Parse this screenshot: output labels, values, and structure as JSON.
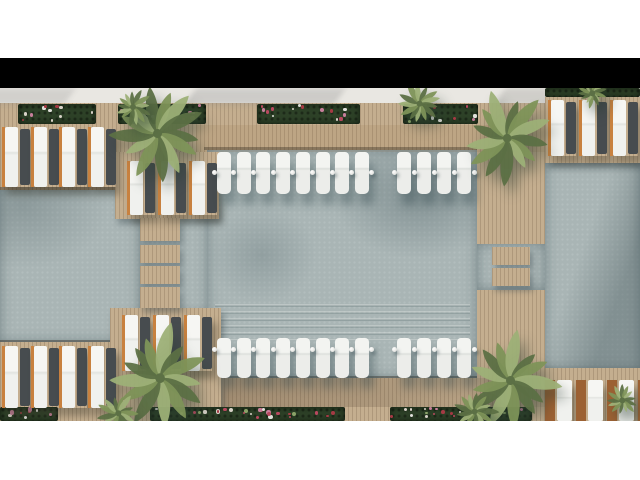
{
  "meta": {
    "scene_label": "top-down resort pool plan rendering",
    "background": "#ffffff",
    "letterbox_bar": "#000000"
  },
  "palette": {
    "sand": "#e9e7e2",
    "wood": "#c4ae8f",
    "woodDark": "#9c8468",
    "water": "#a9b5b5",
    "waterDeep": "#7e9296",
    "green": "#2d4127",
    "lwhite": "#f4f4f1",
    "ldark": "#474c4f",
    "orange": "#c8813f",
    "brown": "#9c6133",
    "palmDark": "#5c7045",
    "palmMid": "#7e9359",
    "palmLight": "#9db077",
    "dot": "#f6f6f4",
    "flowers": [
      "#b8495f",
      "#d8d2c8",
      "#c77f9b",
      "#8aa268",
      "#e0e0da",
      "#a53a44"
    ]
  },
  "frame": {
    "white_top": {
      "y": 0,
      "h": 58
    },
    "black_bar": {
      "y": 58,
      "h": 30
    },
    "white_bottom": {
      "y": 421,
      "h": 59
    }
  },
  "scene": {
    "path_strip": {
      "x": 0,
      "y": 88,
      "w": 640,
      "h": 17
    },
    "greenery_top": {
      "x": 0,
      "y": 103,
      "w": 640,
      "h": 22,
      "planters": [
        [
          18,
          96
        ],
        [
          118,
          206
        ],
        [
          257,
          360
        ],
        [
          403,
          478
        ]
      ]
    },
    "greenery_bottom": {
      "x": 0,
      "y": 407,
      "w": 545,
      "h": 14,
      "planters": [
        [
          0,
          58
        ],
        [
          150,
          345
        ],
        [
          390,
          532
        ]
      ]
    },
    "deck_base": {
      "x": 0,
      "y": 125,
      "w": 640,
      "h": 283
    },
    "pools": [
      {
        "name": "left-pool",
        "x": 0,
        "y": 190,
        "w": 140,
        "h": 152
      },
      {
        "name": "left-channel",
        "x": 140,
        "y": 200,
        "w": 68,
        "h": 115
      },
      {
        "name": "central-pool",
        "x": 207,
        "y": 150,
        "w": 270,
        "h": 228
      },
      {
        "name": "right-channel",
        "x": 477,
        "y": 244,
        "w": 68,
        "h": 46
      },
      {
        "name": "right-pool",
        "x": 545,
        "y": 162,
        "w": 95,
        "h": 208
      }
    ],
    "pool_edges": [
      {
        "x": 204,
        "y": 147,
        "w": 273,
        "h": 3
      },
      {
        "x": 207,
        "y": 376,
        "w": 270,
        "h": 2
      },
      {
        "x": 0,
        "y": 187,
        "w": 140,
        "h": 3
      },
      {
        "x": 0,
        "y": 340,
        "w": 140,
        "h": 2
      },
      {
        "x": 545,
        "y": 159,
        "w": 95,
        "h": 3
      },
      {
        "x": 545,
        "y": 368,
        "w": 95,
        "h": 2
      }
    ],
    "platforms": [
      {
        "name": "deck-topleft-extension",
        "x": 115,
        "y": 152,
        "w": 104,
        "h": 67
      },
      {
        "name": "deck-bottomcenter",
        "x": 110,
        "y": 308,
        "w": 111,
        "h": 113
      },
      {
        "name": "deck-topright-corner",
        "x": 545,
        "y": 97,
        "w": 95,
        "h": 66
      },
      {
        "name": "deck-bottomright-corner",
        "x": 545,
        "y": 368,
        "w": 95,
        "h": 53
      }
    ],
    "bridges": [
      {
        "name": "bridge-left",
        "x": 140,
        "w": 40,
        "segments": [
          [
            218,
            23
          ],
          [
            245,
            18
          ],
          [
            266,
            18
          ],
          [
            287,
            21
          ]
        ]
      },
      {
        "name": "bridge-right",
        "x": 492,
        "w": 38,
        "segments": [
          [
            247,
            18
          ],
          [
            268,
            18
          ]
        ]
      }
    ],
    "green_strip_topright": {
      "x": 545,
      "y": 88,
      "w": 95,
      "h": 9
    },
    "deck_shade_bottom": {
      "x": 196,
      "y": 378,
      "w": 349,
      "h": 29
    },
    "deck_tint_top": {
      "x": 196,
      "y": 125,
      "w": 349,
      "h": 27
    },
    "deck_loungers": [
      {
        "name": "top-left",
        "x": 2,
        "y": 127,
        "pairs": 4,
        "pitch": 28.6,
        "h": 60,
        "style": "owd"
      },
      {
        "name": "top-left-extension",
        "x": 127,
        "y": 161,
        "pairs": 3,
        "pitch": 31,
        "h": 54,
        "style": "owd"
      },
      {
        "name": "bottom-left",
        "x": 2,
        "y": 346,
        "pairs": 4,
        "pitch": 28.6,
        "h": 62,
        "style": "owd"
      },
      {
        "name": "bottom-center",
        "x": 122,
        "y": 315,
        "pairs": 3,
        "pitch": 31,
        "h": 56,
        "style": "owd"
      },
      {
        "name": "top-right",
        "x": 548,
        "y": 100,
        "pairs": 3,
        "pitch": 31,
        "h": 56,
        "style": "owd"
      },
      {
        "name": "bottom-right",
        "x": 545,
        "y": 380,
        "pairs": 4,
        "pitch": 31,
        "h": 41,
        "style": "ow"
      }
    ],
    "pool_lounger_rows": [
      {
        "name": "central-pool-top-row",
        "y": 152,
        "h": 42,
        "dot_y": 170,
        "groups": [
          {
            "x": 217,
            "count": 8,
            "pitch": 19.7
          },
          {
            "x": 397,
            "count": 4,
            "pitch": 20
          }
        ]
      },
      {
        "name": "central-pool-bottom-row",
        "y": 338,
        "h": 40,
        "dot_y": 347,
        "groups": [
          {
            "x": 217,
            "count": 8,
            "pitch": 19.7
          },
          {
            "x": 397,
            "count": 4,
            "pitch": 20
          }
        ]
      }
    ],
    "pool_lounger_w": 14,
    "dot_size": 5,
    "palms": [
      {
        "x": 157,
        "y": 133,
        "r": 50,
        "rot": 8
      },
      {
        "x": 507,
        "y": 138,
        "r": 48,
        "rot": 120
      },
      {
        "x": 160,
        "y": 378,
        "r": 54,
        "rot": 230
      },
      {
        "x": 510,
        "y": 380,
        "r": 50,
        "rot": 60
      },
      {
        "x": 133,
        "y": 107,
        "r": 20,
        "rot": 300
      },
      {
        "x": 420,
        "y": 104,
        "r": 24,
        "rot": 45
      },
      {
        "x": 592,
        "y": 93,
        "r": 15,
        "rot": 180
      },
      {
        "x": 118,
        "y": 413,
        "r": 22,
        "rot": 90
      },
      {
        "x": 475,
        "y": 412,
        "r": 24,
        "rot": 200
      },
      {
        "x": 622,
        "y": 400,
        "r": 16,
        "rot": 20
      }
    ]
  }
}
